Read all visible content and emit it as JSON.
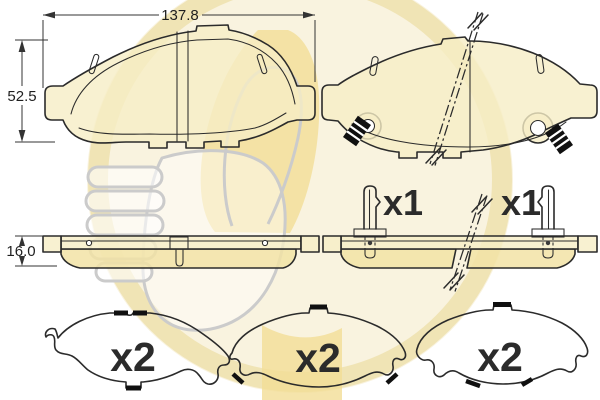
{
  "colors": {
    "background": "#ffffff",
    "line": "#2b2b2b",
    "pad_fill": "#f6eec6",
    "friction_fill": "#f2e3a6",
    "watermark_disc": "#f9f3df",
    "watermark_ring": "#eee0ae",
    "watermark_accent": "#f2dd96",
    "watermark_outline": "#cbcbcb"
  },
  "dimensions": {
    "width": "137.8",
    "height": "52.5",
    "thickness": "16.0"
  },
  "quantities": {
    "sensor_left": "x1",
    "sensor_right": "x1",
    "shim_left": "x2",
    "shim_middle": "x2",
    "shim_right": "x2"
  },
  "watermark": {
    "icon": "girling-thumbs-up-logo"
  }
}
